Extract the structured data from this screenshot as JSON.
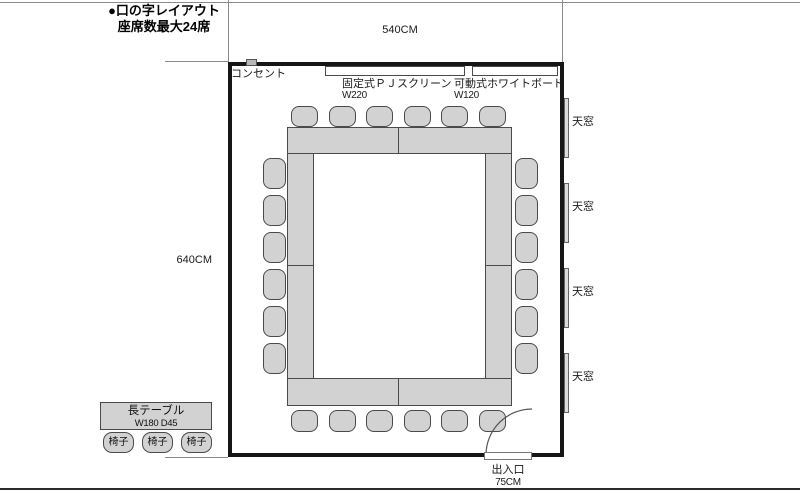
{
  "title": {
    "line1": "●口の字レイアウト",
    "line2": "座席数最大24席"
  },
  "dimensions": {
    "width_label": "540CM",
    "height_label": "640CM"
  },
  "room": {
    "outlet_label": "コンセント",
    "screen": {
      "label": "固定式ＰＪスクリーン",
      "size": "W220"
    },
    "whiteboard": {
      "label": "可動式ホワイトボード",
      "size": "W120"
    },
    "door": {
      "label": "出入口",
      "size": "75CM"
    },
    "skylights": [
      {
        "label": "天窓",
        "x": 564,
        "y": 98,
        "w": 5,
        "h": 60,
        "label_x": 572,
        "label_y": 116
      },
      {
        "label": "天窓",
        "x": 564,
        "y": 183,
        "w": 5,
        "h": 60,
        "label_x": 572,
        "label_y": 201
      },
      {
        "label": "天窓",
        "x": 564,
        "y": 268,
        "w": 5,
        "h": 60,
        "label_x": 572,
        "label_y": 286
      },
      {
        "label": "天窓",
        "x": 564,
        "y": 353,
        "w": 5,
        "h": 60,
        "label_x": 572,
        "label_y": 371
      }
    ]
  },
  "legend": {
    "table": {
      "label": "長テーブル",
      "size": "W180 D45"
    },
    "chairs": [
      {
        "label": "椅子",
        "x": 103
      },
      {
        "label": "椅子",
        "x": 142
      },
      {
        "label": "椅子",
        "x": 181
      }
    ]
  },
  "layout": {
    "seat_count": 24,
    "tables": [
      {
        "name": "table-top-left",
        "x": 287,
        "y": 127,
        "w": 112,
        "h": 27
      },
      {
        "name": "table-top-right",
        "x": 398,
        "y": 127,
        "w": 114,
        "h": 27
      },
      {
        "name": "table-left-upper",
        "x": 287,
        "y": 153,
        "w": 27,
        "h": 113
      },
      {
        "name": "table-left-lower",
        "x": 287,
        "y": 265,
        "w": 27,
        "h": 114
      },
      {
        "name": "table-right-upper",
        "x": 485,
        "y": 153,
        "w": 27,
        "h": 113
      },
      {
        "name": "table-right-lower",
        "x": 485,
        "y": 265,
        "w": 27,
        "h": 114
      },
      {
        "name": "table-bottom-left",
        "x": 287,
        "y": 378,
        "w": 112,
        "h": 28
      },
      {
        "name": "table-bottom-right",
        "x": 398,
        "y": 378,
        "w": 114,
        "h": 28
      }
    ],
    "chairs": [
      {
        "x": 291,
        "y": 106,
        "w": 27,
        "h": 21
      },
      {
        "x": 329,
        "y": 106,
        "w": 27,
        "h": 21
      },
      {
        "x": 366,
        "y": 106,
        "w": 27,
        "h": 21
      },
      {
        "x": 404,
        "y": 106,
        "w": 27,
        "h": 21
      },
      {
        "x": 441,
        "y": 106,
        "w": 27,
        "h": 21
      },
      {
        "x": 479,
        "y": 106,
        "w": 27,
        "h": 21
      },
      {
        "x": 291,
        "y": 410,
        "w": 27,
        "h": 22
      },
      {
        "x": 329,
        "y": 410,
        "w": 27,
        "h": 22
      },
      {
        "x": 366,
        "y": 410,
        "w": 27,
        "h": 22
      },
      {
        "x": 404,
        "y": 410,
        "w": 27,
        "h": 22
      },
      {
        "x": 441,
        "y": 410,
        "w": 27,
        "h": 22
      },
      {
        "x": 479,
        "y": 410,
        "w": 27,
        "h": 22
      },
      {
        "x": 263,
        "y": 158,
        "w": 23,
        "h": 31
      },
      {
        "x": 263,
        "y": 195,
        "w": 23,
        "h": 31
      },
      {
        "x": 263,
        "y": 232,
        "w": 23,
        "h": 31
      },
      {
        "x": 263,
        "y": 269,
        "w": 23,
        "h": 31
      },
      {
        "x": 263,
        "y": 306,
        "w": 23,
        "h": 31
      },
      {
        "x": 263,
        "y": 343,
        "w": 23,
        "h": 31
      },
      {
        "x": 515,
        "y": 158,
        "w": 23,
        "h": 31
      },
      {
        "x": 515,
        "y": 195,
        "w": 23,
        "h": 31
      },
      {
        "x": 515,
        "y": 232,
        "w": 23,
        "h": 31
      },
      {
        "x": 515,
        "y": 269,
        "w": 23,
        "h": 31
      },
      {
        "x": 515,
        "y": 306,
        "w": 23,
        "h": 31
      },
      {
        "x": 515,
        "y": 343,
        "w": 23,
        "h": 31
      }
    ]
  },
  "colors": {
    "furniture_fill": "#d2d2d2",
    "furniture_border": "#4a4a4a",
    "wall": "#161616",
    "thin_line": "#8a8a8a"
  }
}
